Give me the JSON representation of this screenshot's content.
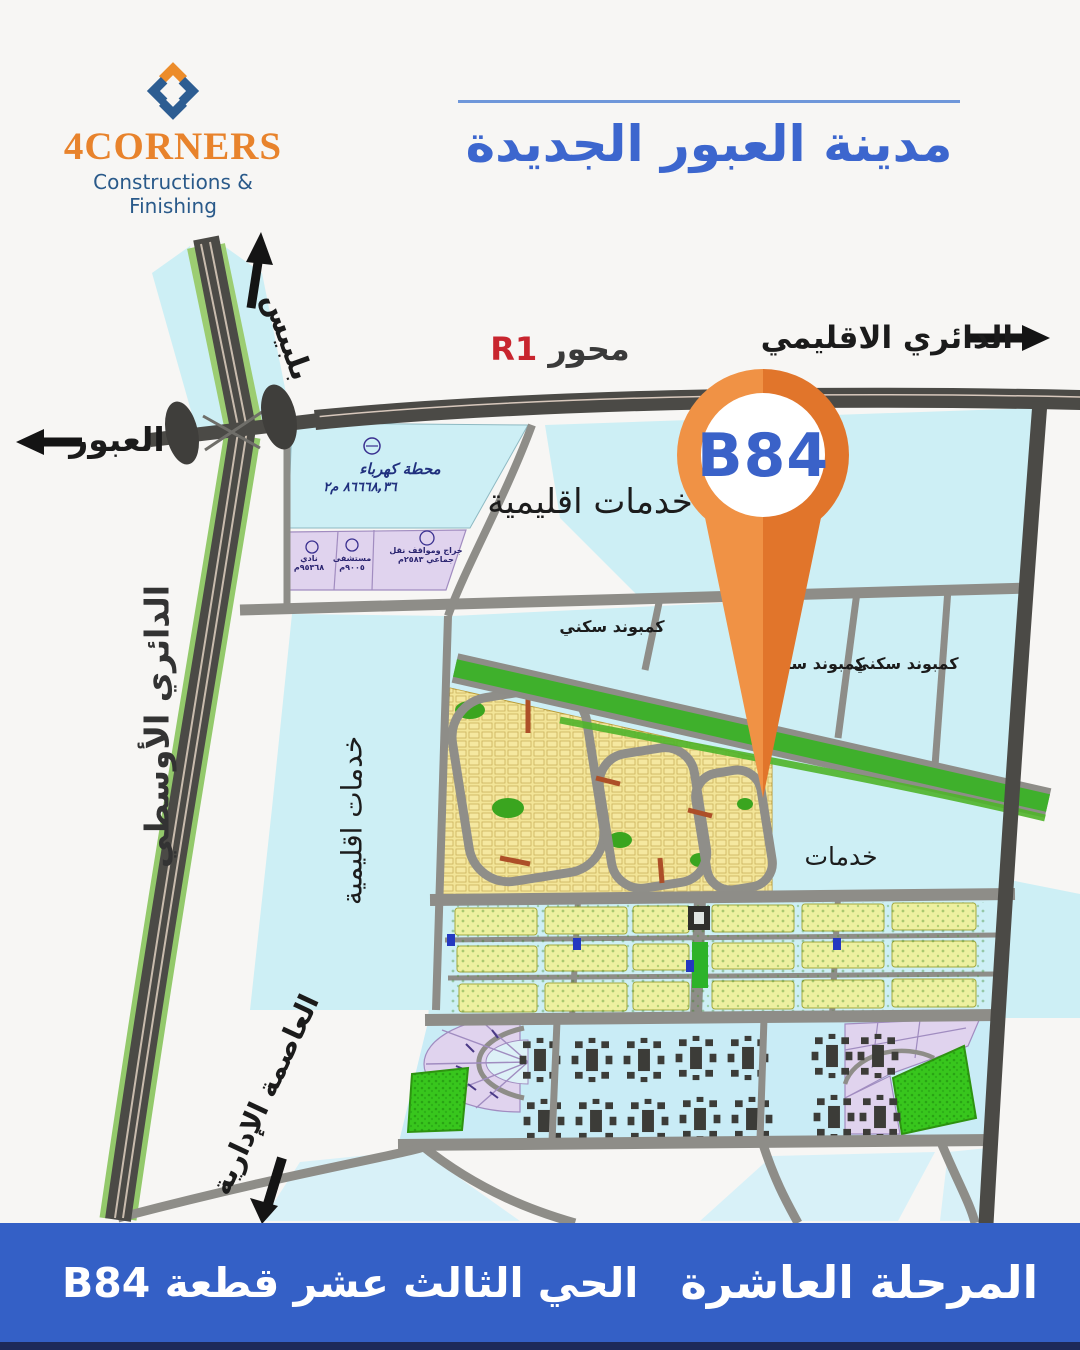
{
  "brand": {
    "name": "4CORNERS",
    "tagline": "Constructions & Finishing",
    "accent_orange": "#e8832c",
    "accent_blue": "#2a5a8a"
  },
  "header": {
    "title": "مدينة العبور الجديدة",
    "title_color": "#3c66ce"
  },
  "map": {
    "pin": {
      "label": "B84",
      "color": "#e8813a",
      "label_color": "#3a62c8"
    },
    "roads": {
      "belbeis": "بلبيس",
      "obour": "العبور",
      "mehwar": "محور",
      "r1": "R1",
      "regional_ring": "الدائري الاقليمي",
      "middle_ring": "الدائري الأوسطي",
      "admin_capital": "العاصمة الإدارية"
    },
    "areas": {
      "regional_services_top": "خدمات اقليمية",
      "regional_services_left": "خدمات اقليمية",
      "services": "خدمات",
      "compound_1": "كمبوند سكني",
      "compound_2": "كمبوند سكني",
      "compound_3": "كمبوند سكني",
      "power_station": "محطة كهرباء",
      "power_station_area": "٨٦٦٦٨,٣٦ م٢",
      "parcel_club": "نادي ٩٥٣٦٨م",
      "parcel_hospital": "مستشفى ٩٠٠٥م",
      "parcel_garage": "جراج ومواقف نقل جماعي ٢٥٨٣م"
    }
  },
  "footer": {
    "phase": "المرحلة العاشرة",
    "district": "الحي الثالث عشر قطعة B84",
    "bg": "#3460c6"
  }
}
